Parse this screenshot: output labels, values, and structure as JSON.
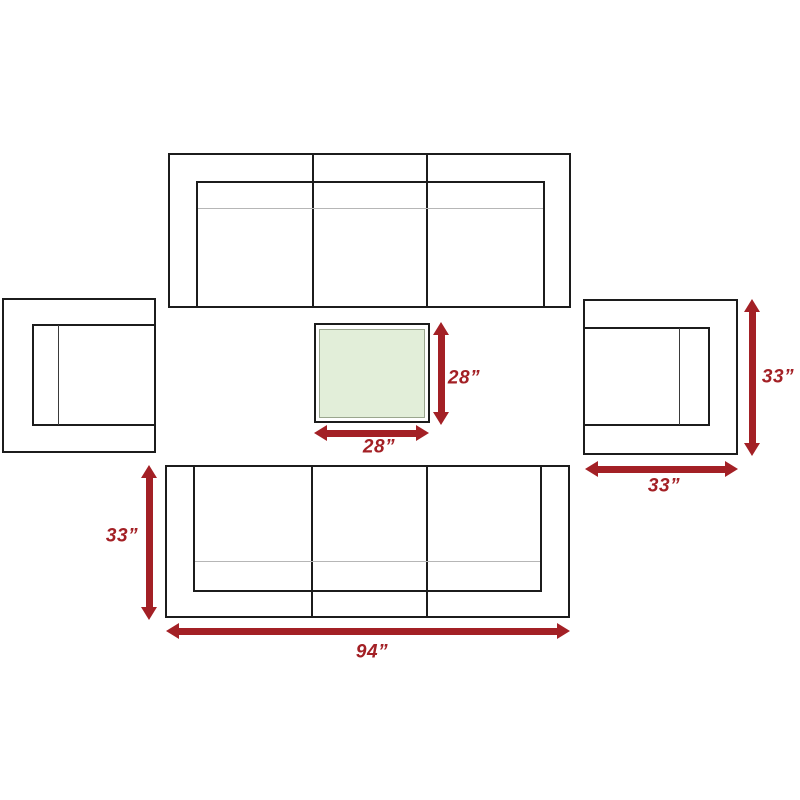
{
  "diagram": {
    "dimensions": {
      "table_height": "28”",
      "table_width": "28”",
      "chair_right_height": "33”",
      "chair_right_width": "33”",
      "sofa_bottom_height": "33”",
      "sofa_bottom_width": "94”"
    },
    "colors": {
      "arrow": "#a32025",
      "outline": "#1c1c1c",
      "seam_line": "#b6b6b6",
      "table_fill": "#e2eed9",
      "table_edge": "#9aa68e"
    }
  }
}
